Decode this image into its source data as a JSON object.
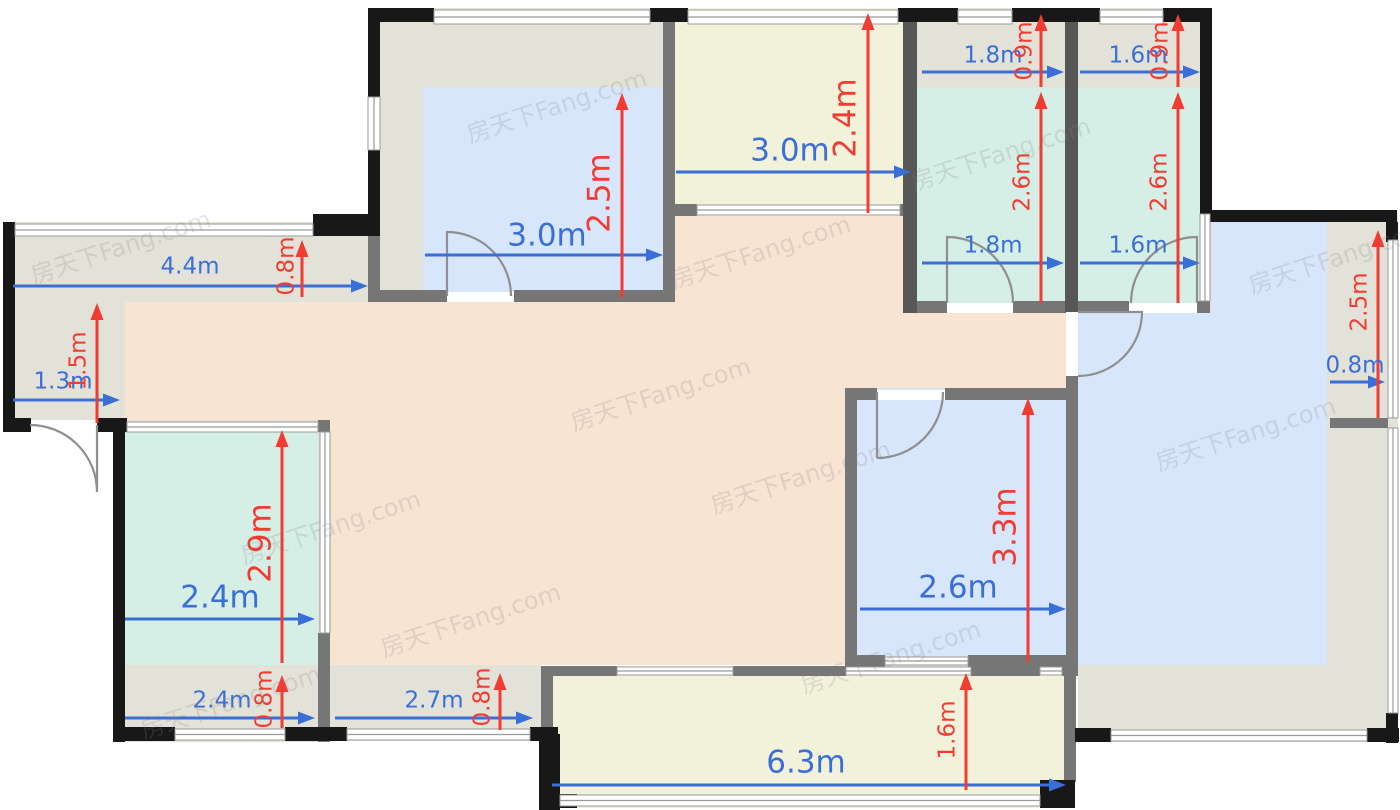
{
  "watermark": {
    "text": "房天下Fang.com"
  },
  "watermark_positions": [
    [
      556,
      104
    ],
    [
      120,
      245
    ],
    [
      660,
      392
    ],
    [
      800,
      475
    ],
    [
      330,
      525
    ],
    [
      230,
      700
    ],
    [
      1000,
      152
    ],
    [
      1245,
      432
    ],
    [
      890,
      655
    ],
    [
      1338,
      255
    ],
    [
      470,
      618
    ],
    [
      760,
      250
    ]
  ],
  "colors": {
    "base": "#e2e2d8",
    "teal": "#d5eee6",
    "blue": "#d8e6fb",
    "orange": "#f7e4d2",
    "cream": "#f2f1da",
    "wallBlack": "#181818",
    "wallGray": "#767676",
    "wallDark": "#575757",
    "window": "#ffffff",
    "windowLine": "#9a9a9a",
    "dimBlue": "#3a6fd8",
    "dimRed": "#f23b31",
    "door": "#8f8f8f"
  },
  "floor": {
    "rooms": [
      [
        3,
        222,
        375,
        80,
        "base",
        "bay-strip-top-left"
      ],
      [
        3,
        302,
        122,
        130,
        "base",
        "entry-hall"
      ],
      [
        125,
        302,
        943,
        88,
        "orange",
        "living-area-band1"
      ],
      [
        125,
        390,
        720,
        35,
        "orange",
        "living-area-band2"
      ],
      [
        330,
        425,
        515,
        240,
        "orange",
        "living-area-center"
      ],
      [
        380,
        216,
        688,
        86,
        "orange",
        "living-area-top"
      ],
      [
        1078,
        216,
        320,
        526,
        "base",
        "bedroom-right-base"
      ],
      [
        1078,
        222,
        249,
        443,
        "blue",
        "bedroom-right-floor"
      ],
      [
        368,
        8,
        307,
        294,
        "base",
        "bedroom-top-left-base"
      ],
      [
        423,
        87,
        242,
        210,
        "blue",
        "bedroom-top-left-floor"
      ],
      [
        663,
        8,
        254,
        208,
        "cream",
        "balcony-top"
      ],
      [
        903,
        8,
        175,
        305,
        "base",
        "bathroom-1-base"
      ],
      [
        917,
        88,
        148,
        215,
        "teal",
        "bathroom-1-floor"
      ],
      [
        1078,
        8,
        134,
        305,
        "base",
        "bathroom-2-base"
      ],
      [
        1078,
        88,
        122,
        215,
        "teal",
        "bathroom-2-floor"
      ],
      [
        113,
        420,
        217,
        322,
        "base",
        "room-bottom-left-base"
      ],
      [
        125,
        425,
        193,
        240,
        "teal",
        "room-bottom-left-floor"
      ],
      [
        845,
        388,
        233,
        279,
        "blue",
        "bedroom-bottom-middle-floor"
      ],
      [
        541,
        666,
        534,
        142,
        "cream",
        "balcony-bottom"
      ],
      [
        330,
        665,
        211,
        76,
        "bay-strip-bottom-2-fill",
        "bay-strip-bottom-2"
      ]
    ],
    "walls_black": [
      [
        368,
        8,
        66,
        14
      ],
      [
        650,
        8,
        38,
        14
      ],
      [
        898,
        8,
        60,
        14
      ],
      [
        1012,
        8,
        88,
        14
      ],
      [
        1163,
        8,
        49,
        14
      ],
      [
        368,
        8,
        12,
        89
      ],
      [
        368,
        150,
        12,
        86
      ],
      [
        1200,
        8,
        12,
        206
      ],
      [
        1210,
        210,
        187,
        12
      ],
      [
        1386,
        222,
        12,
        20
      ],
      [
        1386,
        713,
        12,
        30
      ],
      [
        1367,
        728,
        32,
        14
      ],
      [
        1075,
        728,
        36,
        14
      ],
      [
        3,
        222,
        12,
        210
      ],
      [
        313,
        214,
        65,
        22
      ],
      [
        3,
        418,
        28,
        14
      ],
      [
        97,
        418,
        30,
        14
      ],
      [
        113,
        420,
        12,
        322
      ],
      [
        113,
        727,
        62,
        14
      ],
      [
        285,
        727,
        62,
        14
      ],
      [
        530,
        727,
        28,
        14
      ],
      [
        539,
        734,
        21,
        76
      ],
      [
        539,
        794,
        38,
        14
      ],
      [
        1040,
        780,
        35,
        28
      ]
    ],
    "walls_gray": [
      [
        368,
        236,
        12,
        66
      ],
      [
        368,
        290,
        79,
        12
      ],
      [
        514,
        290,
        149,
        12
      ],
      [
        663,
        8,
        12,
        294
      ],
      [
        663,
        204,
        34,
        12
      ],
      [
        900,
        204,
        17,
        12
      ],
      [
        917,
        301,
        30,
        12
      ],
      [
        1013,
        301,
        52,
        12
      ],
      [
        1078,
        301,
        51,
        12
      ],
      [
        1197,
        301,
        13,
        12
      ],
      [
        1066,
        301,
        12,
        11
      ],
      [
        1066,
        376,
        12,
        24
      ],
      [
        845,
        388,
        32,
        12
      ],
      [
        945,
        388,
        133,
        12
      ],
      [
        845,
        400,
        12,
        267
      ],
      [
        845,
        655,
        40,
        12
      ],
      [
        968,
        655,
        110,
        12
      ],
      [
        1066,
        400,
        12,
        265
      ],
      [
        1066,
        665,
        12,
        11
      ],
      [
        318,
        420,
        12,
        12
      ],
      [
        318,
        633,
        12,
        109
      ],
      [
        551,
        666,
        66,
        10
      ],
      [
        733,
        666,
        113,
        10
      ],
      [
        971,
        666,
        69,
        10
      ],
      [
        1062,
        666,
        11,
        10
      ],
      [
        541,
        666,
        12,
        68
      ],
      [
        1330,
        418,
        58,
        10
      ],
      [
        1064,
        676,
        12,
        106
      ]
    ],
    "walls_dark": [
      [
        903,
        8,
        14,
        305
      ],
      [
        1065,
        8,
        13,
        305
      ]
    ],
    "windows": [
      [
        434,
        10,
        216,
        14,
        "h"
      ],
      [
        688,
        10,
        210,
        14,
        "h"
      ],
      [
        958,
        10,
        54,
        14,
        "h"
      ],
      [
        1100,
        10,
        63,
        14,
        "h"
      ],
      [
        15,
        224,
        298,
        12,
        "h"
      ],
      [
        127,
        422,
        191,
        10,
        "h"
      ],
      [
        175,
        729,
        110,
        11,
        "h"
      ],
      [
        347,
        729,
        183,
        11,
        "h"
      ],
      [
        560,
        795,
        480,
        11,
        "h"
      ],
      [
        1111,
        730,
        256,
        11,
        "h"
      ],
      [
        697,
        205,
        203,
        10,
        "h"
      ],
      [
        617,
        667,
        116,
        8,
        "h"
      ],
      [
        846,
        667,
        125,
        8,
        "h"
      ],
      [
        1040,
        667,
        22,
        8,
        "h"
      ],
      [
        885,
        657,
        83,
        8,
        "h"
      ],
      [
        368,
        97,
        12,
        53,
        "v"
      ],
      [
        1388,
        240,
        10,
        178,
        "v"
      ],
      [
        1388,
        428,
        10,
        285,
        "v"
      ],
      [
        1200,
        214,
        10,
        87,
        "v"
      ],
      [
        320,
        432,
        10,
        201,
        "v"
      ],
      [
        447,
        292,
        67,
        10,
        "g"
      ],
      [
        947,
        303,
        66,
        10,
        "g"
      ],
      [
        1129,
        303,
        68,
        10,
        "g"
      ],
      [
        1066,
        312,
        12,
        64,
        "g"
      ],
      [
        877,
        390,
        68,
        10,
        "g"
      ],
      [
        31,
        420,
        66,
        12,
        "g"
      ]
    ],
    "doors": [
      [
        "M 447 296 L 447 232 A 64 64 0 0 1 511 296",
        "door-bedroom-top-left"
      ],
      [
        "M 97 425 L 97 492 A 67 67 0 0 0 30 425",
        "door-entry"
      ],
      [
        "M 947 303 L 947 237 A 66 66 0 0 1 1013 303",
        "door-bathroom-1"
      ],
      [
        "M 1197 303 L 1197 237 A 66 66 0 0 0 1131 303",
        "door-bathroom-2"
      ],
      [
        "M 1078 312 L 1142 312 A 64 64 0 0 1 1078 376",
        "door-bedroom-right"
      ],
      [
        "M 877 458 L 877 392 M 943 392 A 66 66 0 0 1 877 458",
        "door-bedroom-bottom-middle"
      ]
    ]
  },
  "dimensions": [
    {
      "label": "4.4m",
      "color": "b",
      "dir": "h",
      "x": 13,
      "y": 286,
      "len": 355,
      "tx": 190,
      "ty": 267,
      "size": "md"
    },
    {
      "label": "1.3m",
      "color": "b",
      "dir": "h",
      "x": 13,
      "y": 400,
      "len": 107,
      "tx": 63,
      "ty": 382,
      "size": "md"
    },
    {
      "label": "3.0m",
      "color": "b",
      "dir": "h",
      "x": 425,
      "y": 255,
      "len": 238,
      "tx": 547,
      "ty": 236,
      "size": "lg"
    },
    {
      "label": "3.0m",
      "color": "b",
      "dir": "h",
      "x": 676,
      "y": 172,
      "len": 235,
      "tx": 790,
      "ty": 151,
      "size": "lg"
    },
    {
      "label": "1.8m",
      "color": "b",
      "dir": "h",
      "x": 922,
      "y": 72,
      "len": 142,
      "tx": 993,
      "ty": 56,
      "size": "md"
    },
    {
      "label": "1.8m",
      "color": "b",
      "dir": "h",
      "x": 922,
      "y": 263,
      "len": 142,
      "tx": 993,
      "ty": 246,
      "size": "md"
    },
    {
      "label": "1.6m",
      "color": "b",
      "dir": "h",
      "x": 1080,
      "y": 72,
      "len": 120,
      "tx": 1138,
      "ty": 56,
      "size": "md"
    },
    {
      "label": "1.6m",
      "color": "b",
      "dir": "h",
      "x": 1080,
      "y": 263,
      "len": 120,
      "tx": 1138,
      "ty": 246,
      "size": "md"
    },
    {
      "label": "0.8m",
      "color": "b",
      "dir": "h",
      "x": 1330,
      "y": 382,
      "len": 55,
      "tx": 1355,
      "ty": 366,
      "size": "md"
    },
    {
      "label": "2.4m",
      "color": "b",
      "dir": "h",
      "x": 125,
      "y": 619,
      "len": 190,
      "tx": 220,
      "ty": 598,
      "size": "lg"
    },
    {
      "label": "2.4m",
      "color": "b",
      "dir": "h",
      "x": 125,
      "y": 718,
      "len": 190,
      "tx": 222,
      "ty": 701,
      "size": "md"
    },
    {
      "label": "2.7m",
      "color": "b",
      "dir": "h",
      "x": 335,
      "y": 718,
      "len": 198,
      "tx": 434,
      "ty": 701,
      "size": "md"
    },
    {
      "label": "2.6m",
      "color": "b",
      "dir": "h",
      "x": 860,
      "y": 609,
      "len": 206,
      "tx": 958,
      "ty": 588,
      "size": "lg"
    },
    {
      "label": "6.3m",
      "color": "b",
      "dir": "h",
      "x": 552,
      "y": 785,
      "len": 514,
      "tx": 806,
      "ty": 763,
      "size": "lg"
    },
    {
      "label": "0.8m",
      "color": "r",
      "dir": "v",
      "x": 302,
      "y": 240,
      "len": 57,
      "tx": 287,
      "ty": 266,
      "size": "md"
    },
    {
      "label": "1.5m",
      "color": "r",
      "dir": "v",
      "x": 97,
      "y": 303,
      "len": 120,
      "tx": 79,
      "ty": 361,
      "size": "md"
    },
    {
      "label": "2.5m",
      "color": "r",
      "dir": "v",
      "x": 622,
      "y": 93,
      "len": 204,
      "tx": 600,
      "ty": 193,
      "size": "lg"
    },
    {
      "label": "2.4m",
      "color": "r",
      "dir": "v",
      "x": 868,
      "y": 13,
      "len": 200,
      "tx": 846,
      "ty": 118,
      "size": "lg"
    },
    {
      "label": "0.9m",
      "color": "r",
      "dir": "v",
      "x": 1041,
      "y": 14,
      "len": 73,
      "tx": 1025,
      "ty": 51,
      "size": "md"
    },
    {
      "label": "2.6m",
      "color": "r",
      "dir": "v",
      "x": 1041,
      "y": 92,
      "len": 211,
      "tx": 1023,
      "ty": 182,
      "size": "md"
    },
    {
      "label": "0.9m",
      "color": "r",
      "dir": "v",
      "x": 1178,
      "y": 14,
      "len": 73,
      "tx": 1161,
      "ty": 51,
      "size": "md"
    },
    {
      "label": "2.6m",
      "color": "r",
      "dir": "v",
      "x": 1178,
      "y": 92,
      "len": 211,
      "tx": 1160,
      "ty": 182,
      "size": "md"
    },
    {
      "label": "2.5m",
      "color": "r",
      "dir": "v",
      "x": 1378,
      "y": 230,
      "len": 188,
      "tx": 1360,
      "ty": 302,
      "size": "md"
    },
    {
      "label": "2.9m",
      "color": "r",
      "dir": "v",
      "x": 282,
      "y": 430,
      "len": 233,
      "tx": 261,
      "ty": 543,
      "size": "lg"
    },
    {
      "label": "0.8m",
      "color": "r",
      "dir": "v",
      "x": 282,
      "y": 675,
      "len": 53,
      "tx": 265,
      "ty": 699,
      "size": "md"
    },
    {
      "label": "0.8m",
      "color": "r",
      "dir": "v",
      "x": 500,
      "y": 673,
      "len": 57,
      "tx": 483,
      "ty": 697,
      "size": "md"
    },
    {
      "label": "3.3m",
      "color": "r",
      "dir": "v",
      "x": 1028,
      "y": 398,
      "len": 264,
      "tx": 1006,
      "ty": 527,
      "size": "lg"
    },
    {
      "label": "1.6m",
      "color": "r",
      "dir": "v",
      "x": 966,
      "y": 673,
      "len": 117,
      "tx": 948,
      "ty": 730,
      "size": "md"
    }
  ]
}
